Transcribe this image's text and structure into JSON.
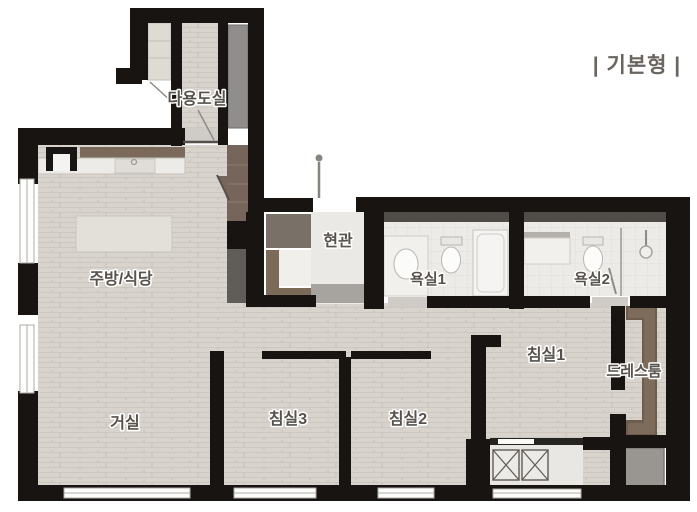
{
  "header": {
    "variant_label": "| 기본형 |"
  },
  "rooms": {
    "utility": "다용도실",
    "kitchen_dining": "주방/식당",
    "entrance": "현관",
    "bathroom1": "욕실1",
    "bathroom2": "욕실2",
    "bedroom1": "침실1",
    "bedroom2": "침실2",
    "bedroom3": "침실3",
    "living": "거실",
    "dressroom": "드레스룸"
  },
  "colors": {
    "wall": "#171412",
    "wood_floor": "#d8d4cd",
    "tile_floor": "#edebe7",
    "cabinet_brown": "#75655a",
    "counter_brown": "#7b6a5b",
    "panel_gray": "#8f8e8c",
    "label_text": "#57524c",
    "header_text": "#6b655f"
  }
}
